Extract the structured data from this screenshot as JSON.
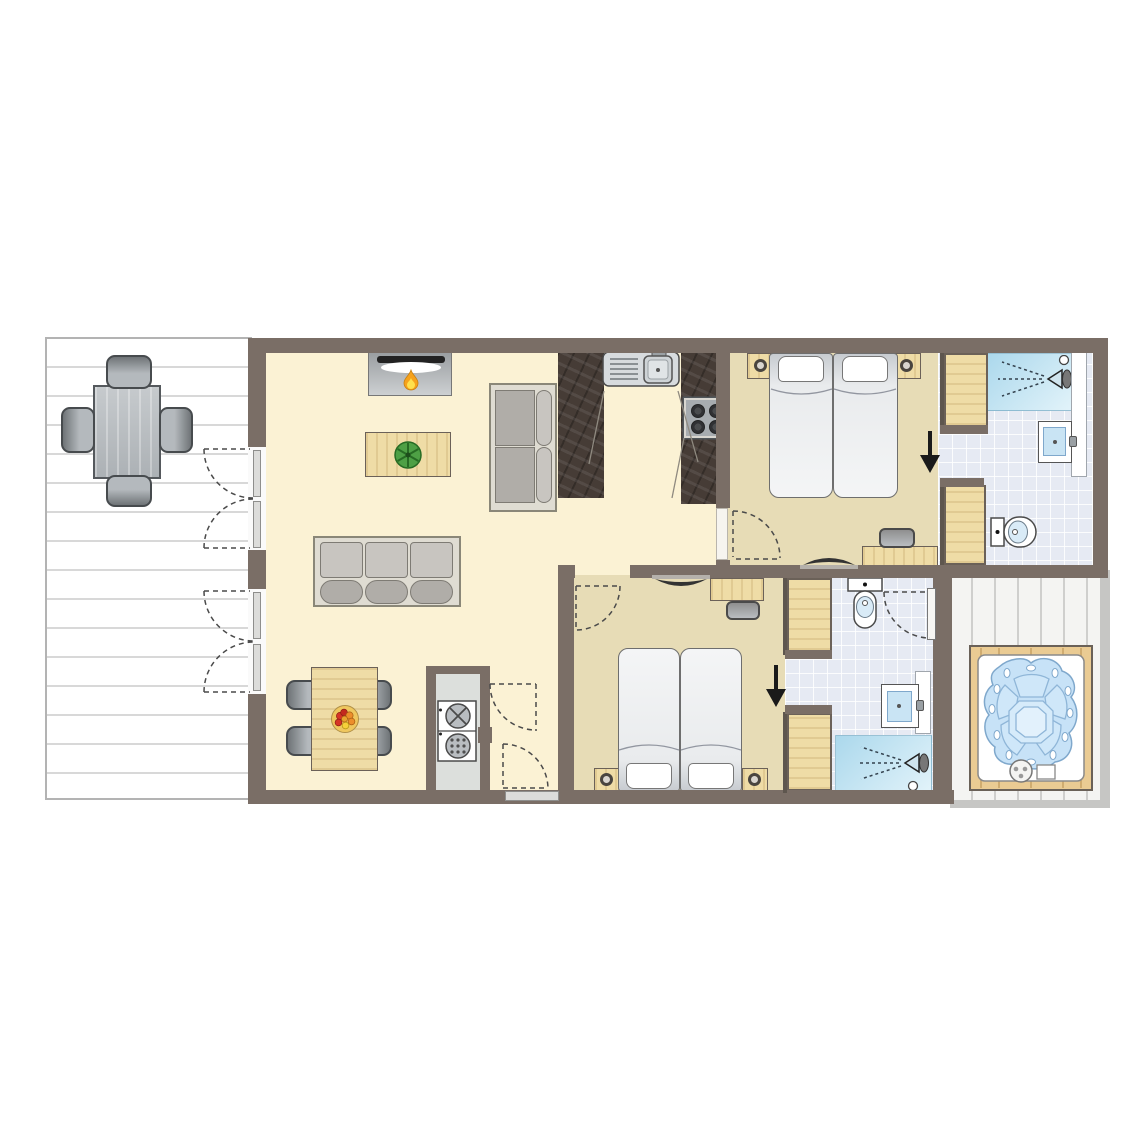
{
  "title": "holiday-lodge-floor-plan",
  "colors": {
    "paper": "#FFFFFF",
    "wall": "#7A6E66",
    "wall-dark": "#5E564E",
    "living-floor": "#FBF2D4",
    "bedroom-floor": "#E7DCB6",
    "tile": "#E6EAF3",
    "shower-from": "#ABD8EC",
    "shower-to": "#E2F3FA",
    "wood": "#EFDCA6",
    "wood-border": "#6B6158",
    "counter": "#463C36",
    "deck-line": "#D8D8D8",
    "deck2-bg": "#F4F4F2",
    "deck2-line": "#CFCFCD",
    "sofa-frame": "#DFDCD2",
    "sofa-border": "#8A8778",
    "cushion": "#C8C5C0",
    "cushion-dark": "#B0ADA8",
    "gray-furniture": "#B9BDC1",
    "water": "#C7E2F7",
    "water-border": "#7FA8CC",
    "tub-wood": "#EACB93",
    "flame": "#F6A21C",
    "flame-inner": "#FFE04D",
    "plant": "#4EA045",
    "plant-dark": "#276B24",
    "arrow": "#1A1A1A",
    "dash": "#4A4A4A"
  },
  "rooms": [
    {
      "name": "terrace-left",
      "items": [
        "outdoor-dining-table",
        "outdoor-chair x4",
        "decking-planks",
        "patio-double-doors x2"
      ]
    },
    {
      "name": "living-room",
      "items": [
        "fireplace",
        "coffee-table",
        "plant",
        "loveseat",
        "three-seat-sofa",
        "dining-table",
        "fruit-bowl",
        "dining-chair x4"
      ]
    },
    {
      "name": "kitchen",
      "items": [
        "counter-left",
        "sink-with-drainer",
        "counter-right",
        "cooktop-4-burners"
      ]
    },
    {
      "name": "utility-closet",
      "items": [
        "washer-dryer-stack",
        "entrance-double-doors",
        "threshold"
      ]
    },
    {
      "name": "bedroom-1",
      "items": [
        "double-bed",
        "pillow x2",
        "nightstand-with-lamp x2",
        "desk",
        "office-chair",
        "tv",
        "entry-arrow",
        "door-swing"
      ]
    },
    {
      "name": "bathroom-1",
      "items": [
        "wardrobe x2",
        "shower",
        "shower-panel",
        "washbasin",
        "toilet"
      ]
    },
    {
      "name": "bedroom-2",
      "items": [
        "double-bed",
        "pillow x2",
        "nightstand-with-lamp x2",
        "desk",
        "office-chair",
        "tv",
        "entry-arrow",
        "door-swing"
      ]
    },
    {
      "name": "bathroom-2",
      "items": [
        "wardrobe x2",
        "toilet",
        "washbasin",
        "shower",
        "door-swing",
        "open-door-leaf"
      ]
    },
    {
      "name": "terrace-right",
      "items": [
        "hot-tub",
        "decking-planks"
      ]
    }
  ]
}
